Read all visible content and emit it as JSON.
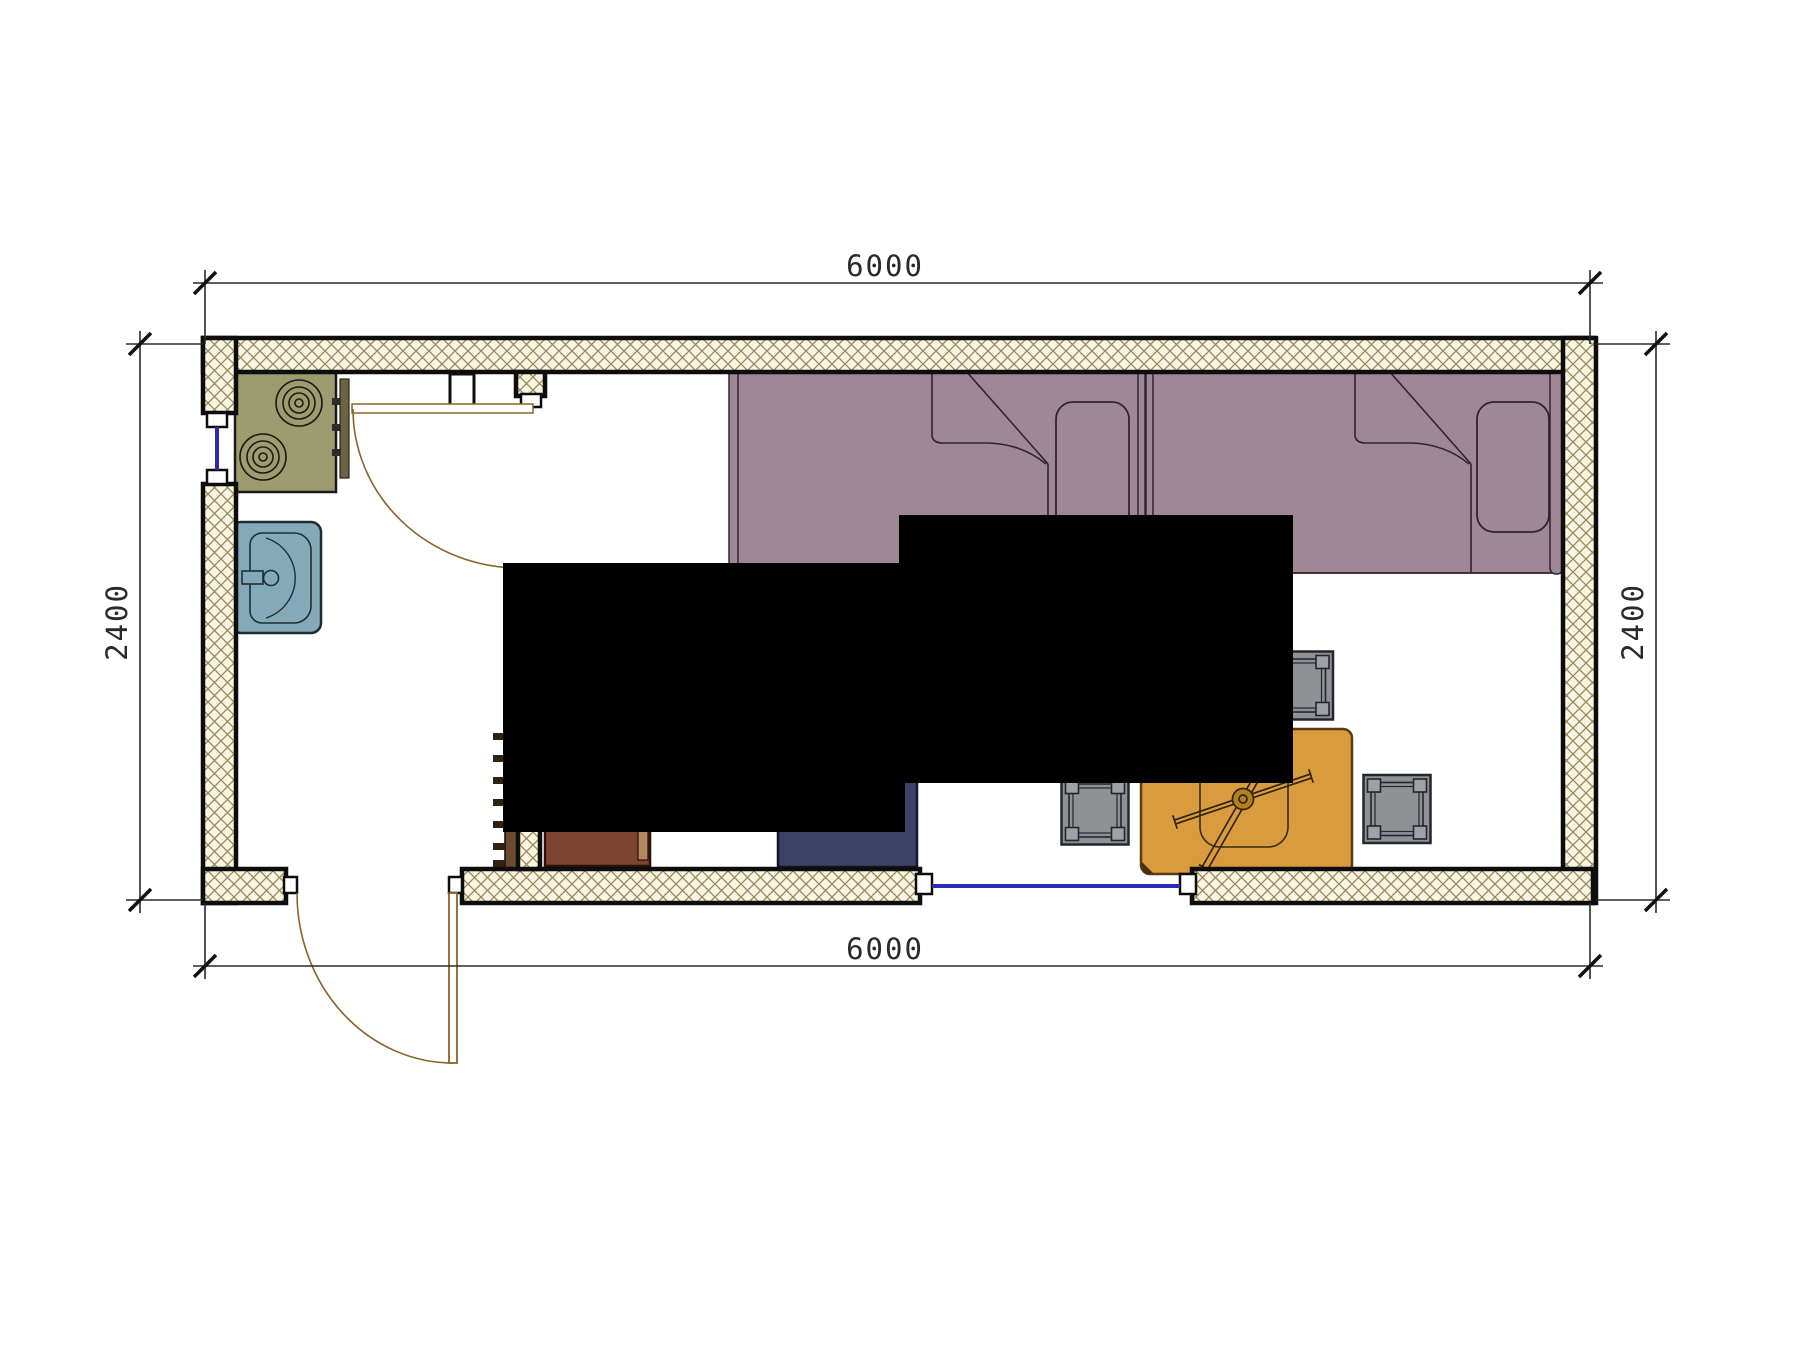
{
  "title": "container-house-floor-plan",
  "watermark": {
    "text": "VANDA",
    "pink": "#f2a9b8",
    "blue": "#aec4dc",
    "text_color": "#ffffff"
  },
  "dimensions": {
    "top": "6000",
    "bottom": "6000",
    "left": "2400",
    "right": "2400"
  },
  "colors": {
    "wall_hatch_bg": "#faf5e3",
    "wall_hatch_line": "#97865a",
    "wall_border": "#0d0d0d",
    "bed": "#9e8895",
    "bed_line": "#33222e",
    "table": "#d89b3d",
    "stool": "#8f9194",
    "stove": "#9c9c6e",
    "sink": "#84a9b8",
    "trunk": "#3c4166",
    "wardrobe": "#7c4531",
    "ladder": "#6a4a30",
    "window_glass": "#2b2bb0",
    "door_arc": "#8a6328",
    "dim_line": "#2a2a2a"
  },
  "objects": [
    "exterior-walls",
    "interior-partition-wall",
    "stove-two-burners",
    "wash-sink",
    "interior-door-swing",
    "entry-door-swing",
    "ladder",
    "wardrobe",
    "storage-trunk",
    "single-bed-left",
    "single-bed-right",
    "pillows",
    "folded-blankets",
    "dining-table-with-cross-brace",
    "stool",
    "stool",
    "stool",
    "stool",
    "window-left-wall",
    "window-bottom-wall"
  ]
}
